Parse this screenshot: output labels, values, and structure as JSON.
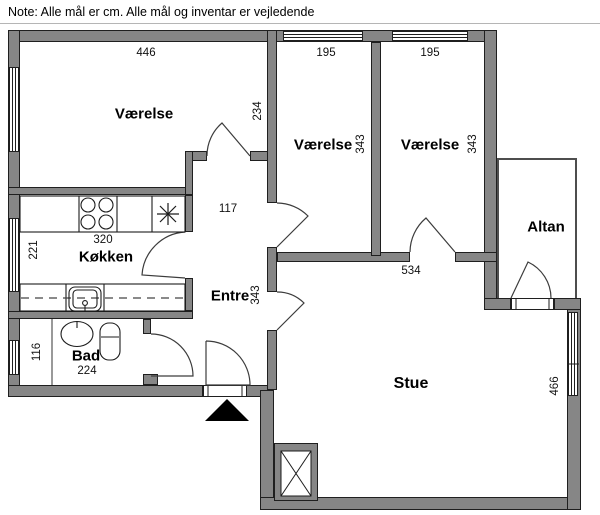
{
  "note": "Note: Alle mål er cm. Alle mål og inventar er vejledende",
  "rooms": [
    {
      "id": "vaerelse-1",
      "name": "Værelse",
      "width_cm": "446",
      "depth_cm": "234"
    },
    {
      "id": "vaerelse-2",
      "name": "Værelse",
      "width_cm": "195",
      "depth_cm": "343"
    },
    {
      "id": "vaerelse-3",
      "name": "Værelse",
      "width_cm": "195",
      "depth_cm": "343"
    },
    {
      "id": "koekken",
      "name": "Køkken",
      "width_cm": "320",
      "depth_cm": "221"
    },
    {
      "id": "entre",
      "name": "Entre",
      "width_cm": "117",
      "depth_cm": "343"
    },
    {
      "id": "bad",
      "name": "Bad",
      "width_cm": "224",
      "depth_cm": "116"
    },
    {
      "id": "stue",
      "name": "Stue",
      "width_cm": "534",
      "depth_cm": "466"
    },
    {
      "id": "altan",
      "name": "Altan"
    }
  ],
  "icons": {
    "entrance-marker": "black triangle pointing up at main entrance",
    "shaft": "square with X (duct/shaft)",
    "stove": "four burner circles",
    "cooktop-star": "asterisk appliance symbol",
    "sink": "kitchen sink with drain",
    "washbasin": "round hand basin with tap",
    "toilet": "wc with cistern",
    "door-swing": "quarter-circle door arc",
    "window": "double-line window in wall"
  },
  "colors": {
    "wall": "#868686",
    "wall_outline": "#1f1f1f",
    "thin_wall": "#4e4e4e",
    "note_rule": "#b5b5b5",
    "marker": "#000000",
    "background": "#ffffff"
  }
}
